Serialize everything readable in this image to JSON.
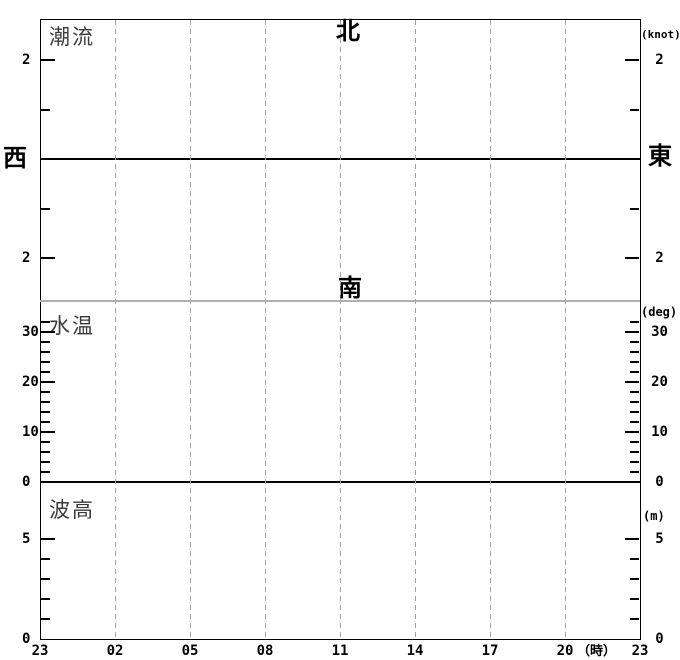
{
  "chart_data": [
    {
      "panel": "tidal-current",
      "type": "line",
      "title": "潮流",
      "unit": "(knot)",
      "direction_labels": {
        "top": "北",
        "bottom": "南",
        "left": "西",
        "right": "東"
      },
      "y_axis": {
        "labeled_tick_values": [
          2,
          -2
        ],
        "labeled_tick_text": [
          "2",
          "2"
        ],
        "minor_tick_values": [
          1,
          -1
        ],
        "zero_line": true,
        "approx_range": [
          -2.9,
          2.9
        ]
      },
      "series": [],
      "note": "no data plotted - empty axes template"
    },
    {
      "panel": "water-temperature",
      "type": "line",
      "title": "水温",
      "unit": "(deg)",
      "y_axis": {
        "labeled_tick_values": [
          30,
          20,
          10,
          0
        ],
        "labeled_tick_text": [
          "30",
          "20",
          "10",
          "0"
        ],
        "minor_tick_step": 2,
        "minor_tick_values": [
          32,
          28,
          26,
          24,
          22,
          18,
          16,
          14,
          12,
          8,
          6,
          4,
          2
        ],
        "approx_range": [
          0,
          36
        ]
      },
      "series": [],
      "note": "no data plotted - empty axes template"
    },
    {
      "panel": "wave-height",
      "type": "line",
      "title": "波高",
      "unit": "(m)",
      "y_axis": {
        "labeled_tick_values": [
          5,
          0
        ],
        "labeled_tick_text": [
          "5",
          "0"
        ],
        "minor_tick_values": [
          4,
          3,
          2,
          1
        ],
        "approx_range": [
          0,
          7.8
        ]
      },
      "series": [],
      "note": "no data plotted - empty axes template"
    }
  ],
  "x_axis": {
    "tick_labels": [
      "23",
      "02",
      "05",
      "08",
      "11",
      "14",
      "17",
      "20",
      "23"
    ],
    "unit_suffix": "（時）",
    "step_hours": 3,
    "grid": "dashed vertical lines at every labeled hour"
  },
  "labels": {
    "current_title": "潮流",
    "temp_title": "水温",
    "wave_title": "波高",
    "north": "北",
    "south": "南",
    "west": "西",
    "east": "東",
    "knot_unit": "(knot)",
    "deg_unit": "(deg)",
    "m_unit": "(m)",
    "current_upper_2": "2",
    "current_lower_2": "2",
    "temp_30": "30",
    "temp_20": "20",
    "temp_10": "10",
    "temp_0": "0",
    "wave_5": "5",
    "wave_0": "0"
  },
  "colors": {
    "background": "#ffffff",
    "axis": "#000000",
    "gridline": "#a3a3a3",
    "separator_line": "#b0b0b0",
    "title_text": "#3a3a3a"
  }
}
